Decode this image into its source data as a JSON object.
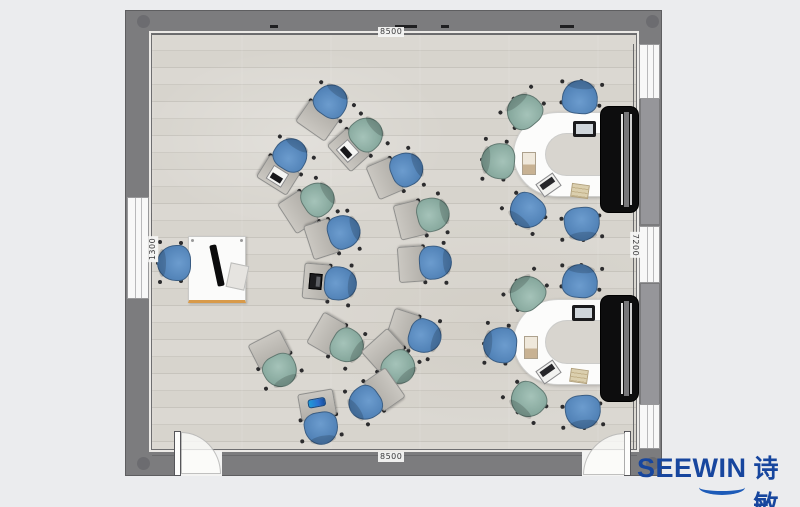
{
  "dimensions": {
    "top": "8500",
    "bottom": "8500",
    "left": "1300",
    "right": "7200"
  },
  "logo": {
    "brand": "SEEWIN",
    "cjk": "诗敏",
    "color": "#17469e"
  },
  "palette": {
    "chair_blue": "#5688bd",
    "chair_green": "#8fb0a5",
    "tablet_gray": "#b7b4ae",
    "wall_gray": "#7c7c7e",
    "floor_wood": "#d8d5cf",
    "desk_white": "#fbfbfa",
    "display_black": "#0d0d0e",
    "desk_edge_orange": "#d89a4a"
  },
  "teacher": {
    "desk": {
      "x": 188,
      "y": 236,
      "w": 58,
      "h": 67
    },
    "chair": {
      "x": 174,
      "y": 263,
      "color": "blue",
      "angle": 90
    }
  },
  "node_chairs": [
    {
      "x": 327,
      "y": 107,
      "color": "blue",
      "angle": 215,
      "item": null
    },
    {
      "x": 361,
      "y": 139,
      "color": "green",
      "angle": 228,
      "item": "laptop-white"
    },
    {
      "x": 287,
      "y": 161,
      "color": "blue",
      "angle": 212,
      "item": "laptop-white"
    },
    {
      "x": 400,
      "y": 172,
      "color": "blue",
      "angle": 247,
      "item": null
    },
    {
      "x": 312,
      "y": 203,
      "color": "green",
      "angle": 237,
      "item": null
    },
    {
      "x": 426,
      "y": 216,
      "color": "green",
      "angle": 256,
      "item": null
    },
    {
      "x": 337,
      "y": 234,
      "color": "blue",
      "angle": 252,
      "item": null
    },
    {
      "x": 428,
      "y": 263,
      "color": "blue",
      "angle": 266,
      "item": null
    },
    {
      "x": 333,
      "y": 283,
      "color": "blue",
      "angle": 275,
      "item": "laptop-black"
    },
    {
      "x": 418,
      "y": 334,
      "color": "blue",
      "angle": 288,
      "item": null
    },
    {
      "x": 341,
      "y": 342,
      "color": "green",
      "angle": 300,
      "item": null
    },
    {
      "x": 277,
      "y": 364,
      "color": "green",
      "angle": 333,
      "item": null
    },
    {
      "x": 394,
      "y": 362,
      "color": "green",
      "angle": 318,
      "item": null
    },
    {
      "x": 371,
      "y": 399,
      "color": "blue",
      "angle": 55,
      "item": null
    },
    {
      "x": 320,
      "y": 421,
      "color": "blue",
      "angle": 350,
      "item": "pencil-case"
    }
  ],
  "stations": [
    {
      "table": {
        "x": 513,
        "y": 112,
        "w": 99,
        "h": 85
      },
      "display": {
        "x": 600,
        "y": 106
      },
      "panel": {
        "y": 98,
        "h": 127
      },
      "chairs": [
        {
          "x": 580,
          "y": 97,
          "color": "blue",
          "angle": 185
        },
        {
          "x": 524,
          "y": 111,
          "color": "green",
          "angle": 140
        },
        {
          "x": 498,
          "y": 161,
          "color": "green",
          "angle": 95
        },
        {
          "x": 527,
          "y": 211,
          "color": "blue",
          "angle": 40
        },
        {
          "x": 582,
          "y": 224,
          "color": "blue",
          "angle": 355
        }
      ],
      "items": [
        {
          "type": "monitor",
          "x": 583,
          "y": 129,
          "angle": 0
        },
        {
          "type": "cabinet",
          "x": 532,
          "y": 160,
          "angle": 0
        },
        {
          "type": "laptop",
          "x": 548,
          "y": 185,
          "angle": -35
        },
        {
          "type": "papers",
          "x": 581,
          "y": 192,
          "angle": 8
        }
      ]
    },
    {
      "table": {
        "x": 513,
        "y": 299,
        "w": 99,
        "h": 86
      },
      "display": {
        "x": 600,
        "y": 295
      },
      "panel": {
        "y": 283,
        "h": 122
      },
      "chairs": [
        {
          "x": 580,
          "y": 281,
          "color": "blue",
          "angle": 185
        },
        {
          "x": 527,
          "y": 293,
          "color": "green",
          "angle": 140
        },
        {
          "x": 500,
          "y": 345,
          "color": "blue",
          "angle": 95
        },
        {
          "x": 528,
          "y": 400,
          "color": "green",
          "angle": 40
        },
        {
          "x": 583,
          "y": 412,
          "color": "blue",
          "angle": 355
        }
      ],
      "items": [
        {
          "type": "monitor",
          "x": 582,
          "y": 313,
          "angle": 0
        },
        {
          "type": "cabinet",
          "x": 534,
          "y": 344,
          "angle": 0
        },
        {
          "type": "laptop",
          "x": 548,
          "y": 372,
          "angle": -35
        },
        {
          "type": "papers",
          "x": 580,
          "y": 377,
          "angle": 8
        }
      ]
    }
  ],
  "doors": [
    {
      "x": 180,
      "w": 42,
      "hinge": "left"
    },
    {
      "x": 582,
      "w": 44,
      "hinge": "right"
    }
  ],
  "windows": {
    "right": [
      {
        "y": 44,
        "h": 55
      },
      {
        "y": 226,
        "h": 57
      },
      {
        "y": 404,
        "h": 45
      }
    ],
    "left": [
      {
        "y": 197,
        "h": 102
      }
    ]
  },
  "posts": [
    {
      "x": 137,
      "y": 15
    },
    {
      "x": 646,
      "y": 15
    },
    {
      "x": 137,
      "y": 457
    },
    {
      "x": 646,
      "y": 457
    }
  ],
  "dashes": [
    {
      "x": 270,
      "w": 8
    },
    {
      "x": 395,
      "w": 22
    },
    {
      "x": 441,
      "w": 8
    },
    {
      "x": 560,
      "w": 14
    }
  ]
}
